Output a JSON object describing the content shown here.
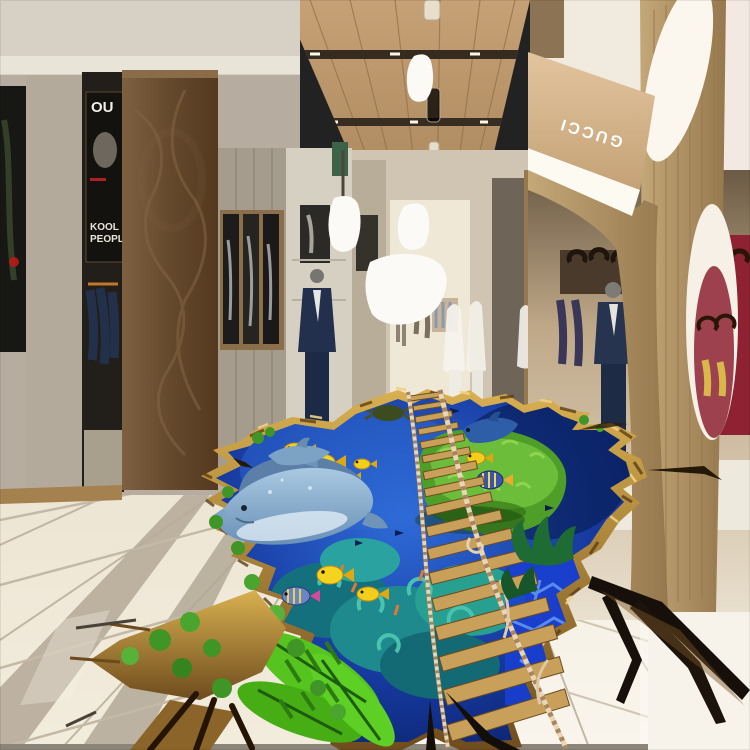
{
  "scene": {
    "description": "Mall corridor with 3D underwater floor mural",
    "store_sign": {
      "label": "GUCCI"
    },
    "magazine_poster": {
      "headline": "OU",
      "line1": "KOOL",
      "line2": "PEOPLE"
    }
  },
  "palette": {
    "ceiling_wood": "#b9946a",
    "walnut_pillar": "#6e5336",
    "oak_partition": "#b59a6e",
    "wall_beige": "#b3aa9d",
    "floor_cream": "#efe7d6",
    "floor_light": "#f6f1e7",
    "grout": "#a89d8c",
    "water_deep": "#0d2d8a",
    "water_bright": "#2e6bd4",
    "rock_gold": "#c0913a",
    "island_green": "#55a52c",
    "leaf_green": "#55c41e",
    "coral_teal": "#1f8a8e",
    "fish_yellow": "#f2cf1a",
    "dolphin_blue": "#8fb4d4",
    "sign_text": "#ffffff",
    "crack_dark": "#17100a"
  }
}
